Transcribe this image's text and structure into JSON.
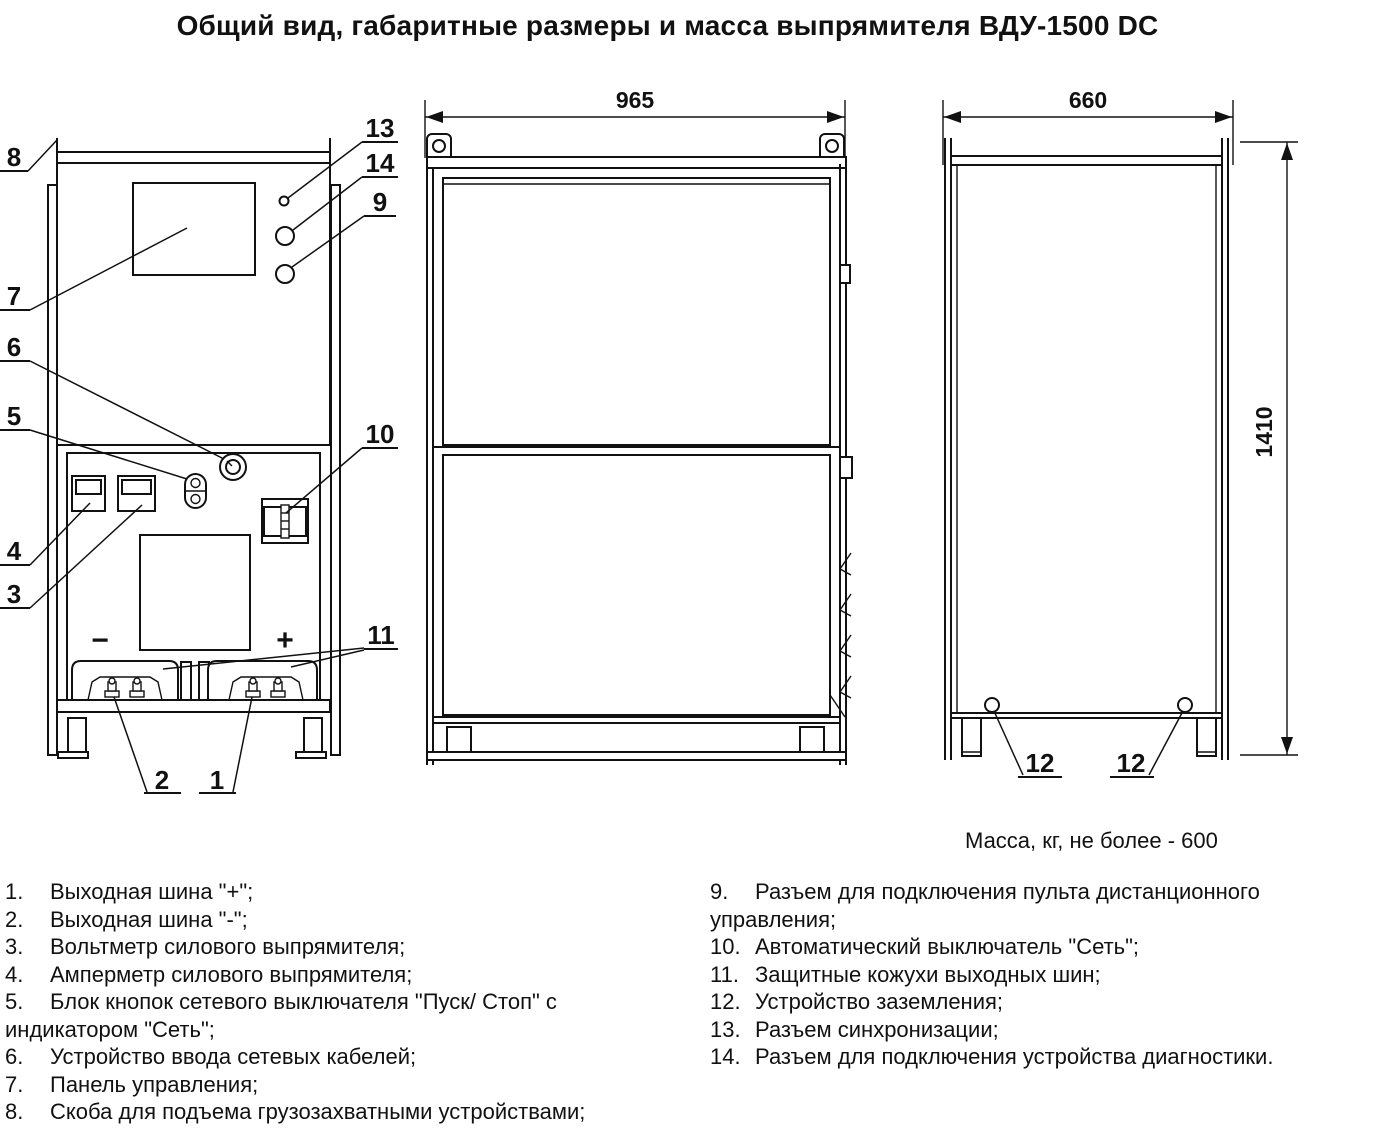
{
  "title": "Общий вид, габаритные размеры и масса выпрямителя ВДУ-1500 DC",
  "mass_note": "Масса, кг, не более - 600",
  "dimensions": {
    "side_width": "965",
    "front_width": "660",
    "height": "1410"
  },
  "polarity": {
    "minus": "−",
    "plus": "+"
  },
  "callouts": {
    "n1": "1",
    "n2": "2",
    "n3": "3",
    "n4": "4",
    "n5": "5",
    "n6": "6",
    "n7": "7",
    "n8": "8",
    "n9": "9",
    "n10": "10",
    "n11": "11",
    "n12": "12",
    "n13": "13",
    "n14": "14"
  },
  "legend": {
    "left": [
      {
        "num": "1.",
        "text": "Выходная шина \"+\";"
      },
      {
        "num": "2.",
        "text": "Выходная шина \"-\";"
      },
      {
        "num": "3.",
        "text": "Вольтметр силового выпрямителя;"
      },
      {
        "num": "4.",
        "text": "Амперметр силового выпрямителя;"
      },
      {
        "num": "5.",
        "text": "Блок кнопок сетевого выключателя \"Пуск/ Стоп\" с индикатором \"Сеть\";"
      },
      {
        "num": "6.",
        "text": "Устройство ввода сетевых кабелей;"
      },
      {
        "num": "7.",
        "text": "Панель управления;"
      },
      {
        "num": "8.",
        "text": "Скоба для подъема грузозахватными устройствами;"
      }
    ],
    "right": [
      {
        "num": "9.",
        "text": "Разъем для подключения пульта дистанционного управления;"
      },
      {
        "num": "10.",
        "text": "Автоматический выключатель \"Сеть\";"
      },
      {
        "num": "11.",
        "text": "Защитные кожухи выходных шин;"
      },
      {
        "num": "12.",
        "text": "Устройство заземления;"
      },
      {
        "num": "13.",
        "text": "Разъем синхронизации;"
      },
      {
        "num": "14.",
        "text": "Разъем для подключения устройства диагностики."
      }
    ]
  }
}
